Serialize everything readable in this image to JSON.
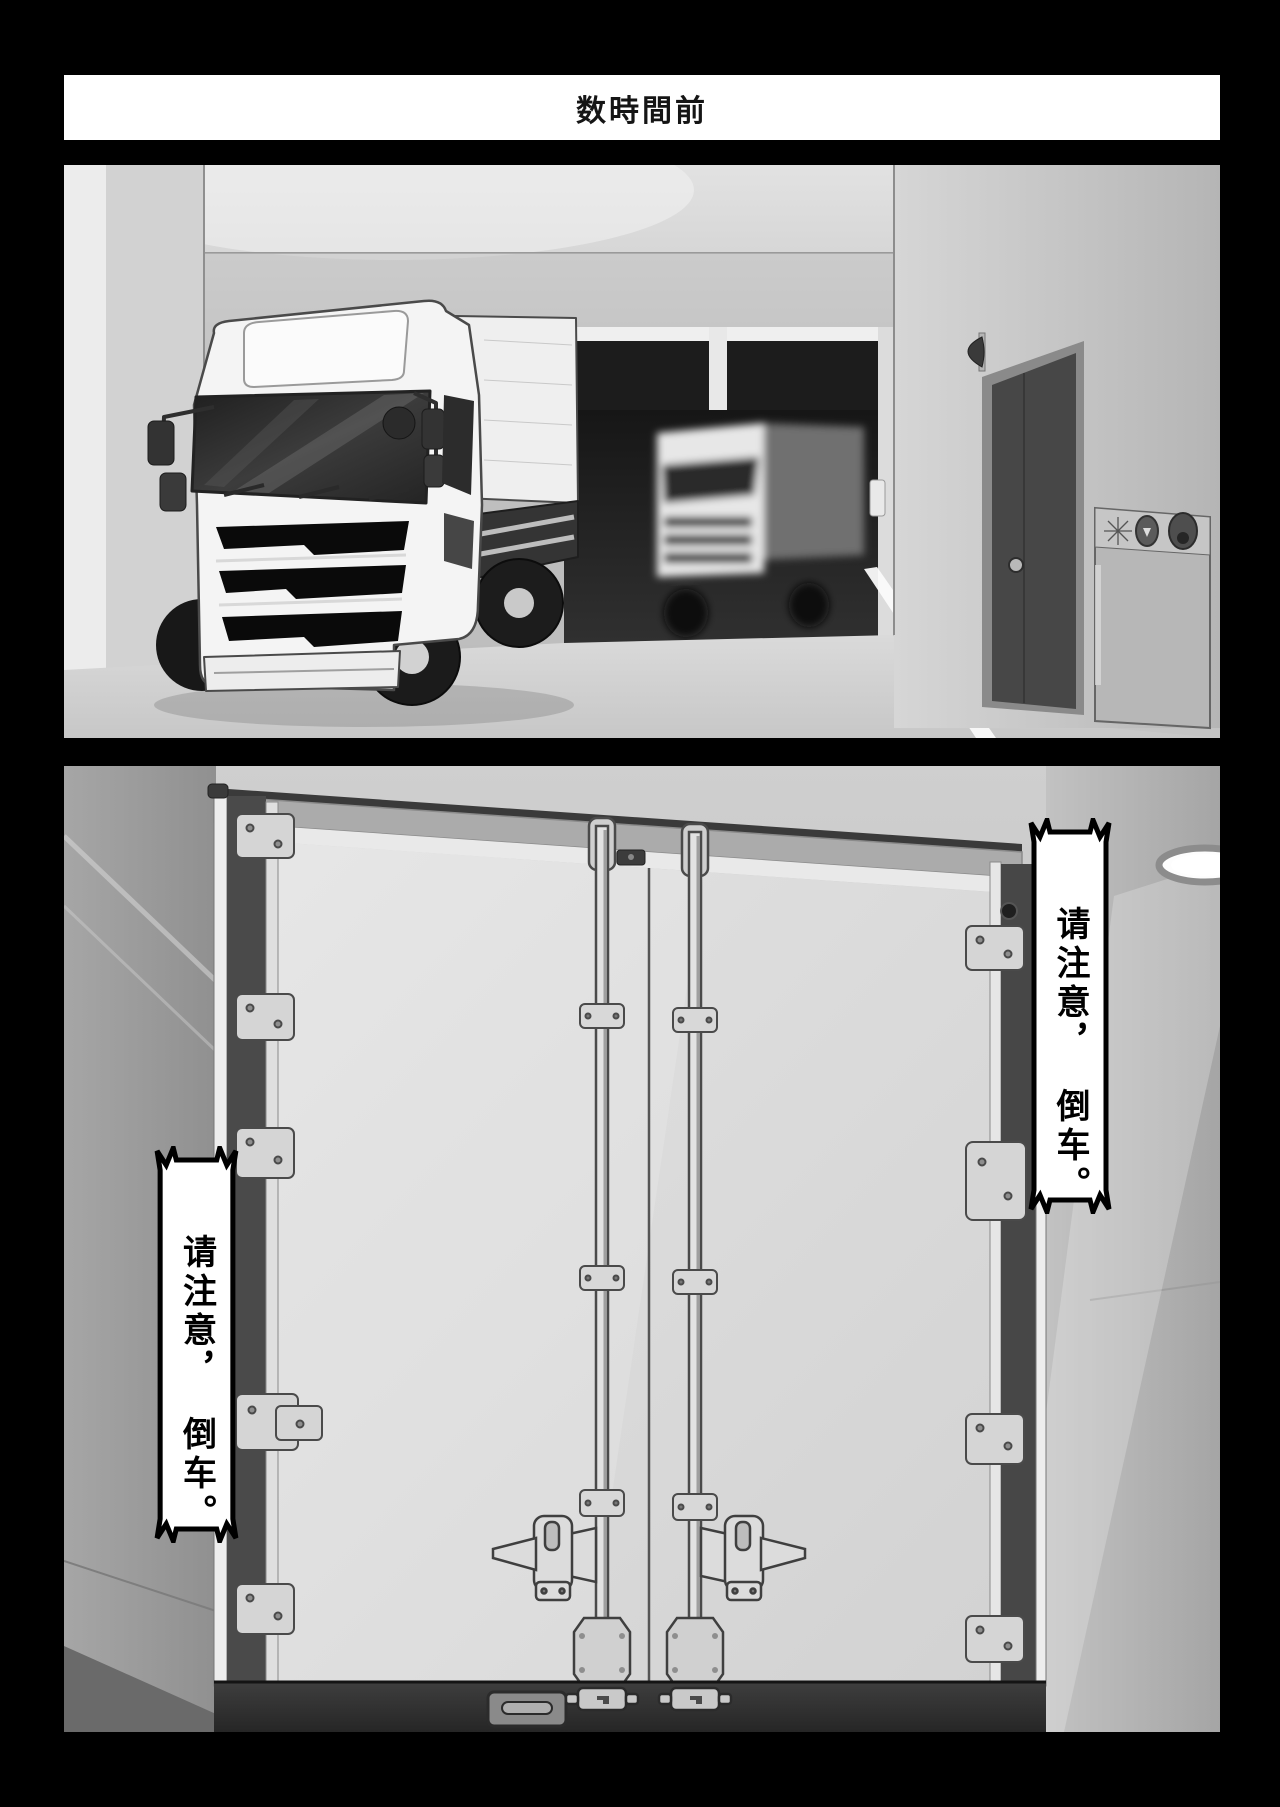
{
  "page": {
    "background": "#000000",
    "gutter_color": "#000000"
  },
  "banner": {
    "text": "数時間前",
    "background": "#ffffff",
    "text_color": "#151515"
  },
  "bubbles": {
    "right": {
      "line1": "请注意，",
      "line2": "倒车。"
    },
    "left": {
      "line1": "请注意，",
      "line2": "倒车。"
    }
  },
  "colors": {
    "panel_wall": "#c6c6c6",
    "truck_body": "#f4f4f4",
    "windshield": "#2e2e2e",
    "door_slab": "#474747",
    "bumper_dark": "#313131"
  }
}
